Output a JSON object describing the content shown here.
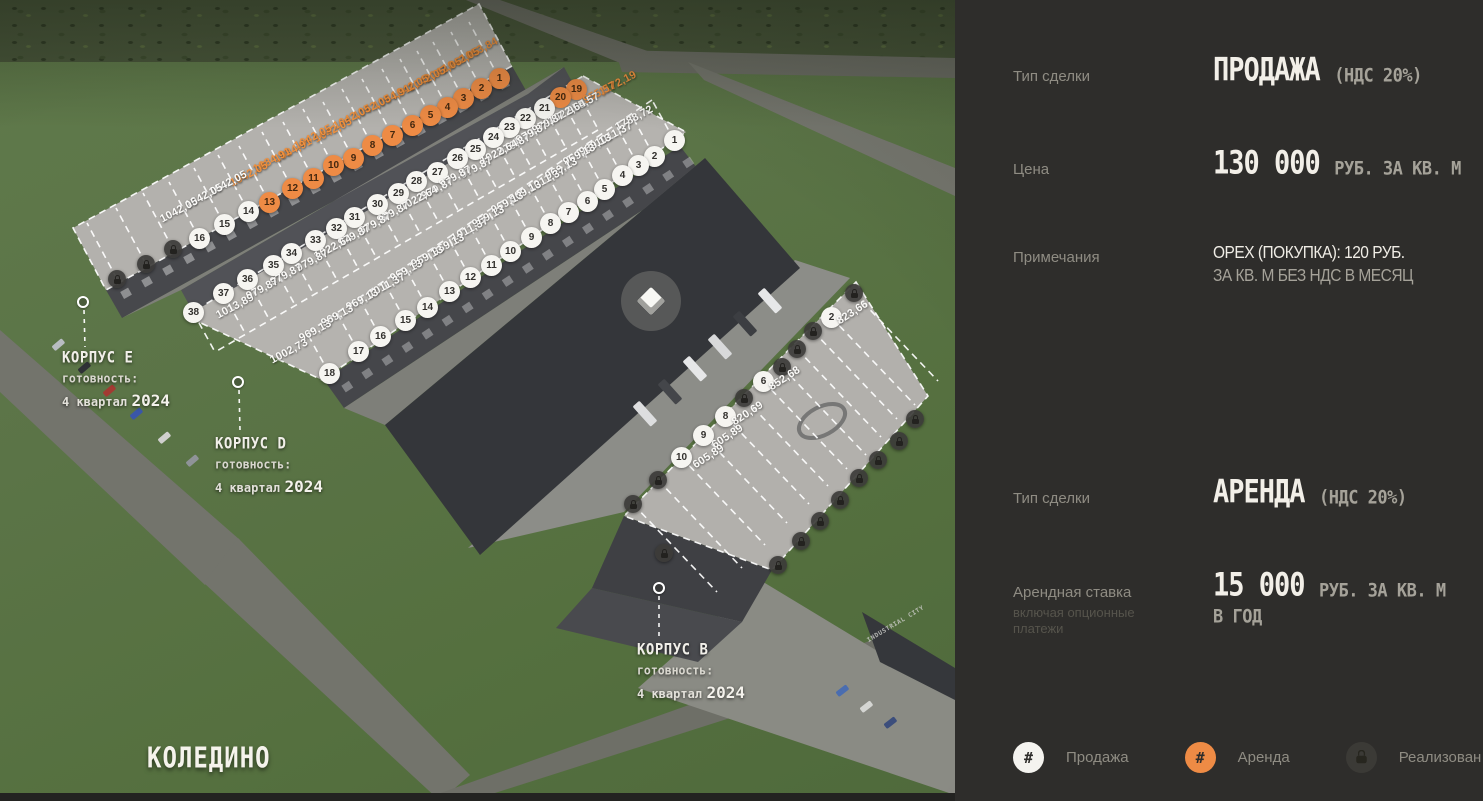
{
  "project": {
    "title": "КОЛЕДИНО"
  },
  "sidebar": {
    "sale": {
      "type_label": "Тип сделки",
      "type_value": "ПРОДАЖА",
      "vat": "(НДС 20%)",
      "price_label": "Цена",
      "price_value": "130 000",
      "price_unit": "РУБ. ЗА КВ. М",
      "notes_label": "Примечания",
      "note_line1": "OPEX (ПОКУПКА): 120 РУБ.",
      "note_line2": "ЗА КВ. М БЕЗ НДС В МЕСЯЦ"
    },
    "rent": {
      "type_label": "Тип сделки",
      "type_value": "АРЕНДА",
      "vat": "(НДС 20%)",
      "rate_label": "Арендная ставка",
      "rate_sublabel1": "включая опционные",
      "rate_sublabel2": "платежи",
      "rate_value": "15 000",
      "rate_unit": "РУБ. ЗА КВ. М",
      "rate_unit2": "В ГОД"
    },
    "legend": [
      {
        "type": "sale",
        "icon": "#",
        "label": "Продажа"
      },
      {
        "type": "rent",
        "icon": "#",
        "label": "Аренда"
      },
      {
        "type": "sold",
        "icon": "lock",
        "label": "Реализован"
      }
    ]
  },
  "map": {
    "sign": "INDUSTRIAL CITY",
    "colors": {
      "accent_orange": "#ee8b45",
      "sale_white": "#f6f5f1",
      "sold_gray": "#3c3b38"
    },
    "buildings": [
      {
        "id": "E",
        "name": "КОРПУС E",
        "ready_label": "готовность:",
        "ready_quarter": "4 квартал",
        "ready_year": "2024",
        "label_x": 62,
        "label_y": 350,
        "dot_x": 83,
        "dot_y": 302,
        "rows": [
          {
            "geom": "E",
            "units": [
              {
                "num": "1",
                "status": "rent",
                "area": "1053,84",
                "x": 499,
                "y": 78,
                "lx": 461,
                "ly": 60
              },
              {
                "num": "2",
                "status": "rent",
                "area": "1042,05",
                "x": 481,
                "y": 88,
                "lx": 443,
                "ly": 70
              },
              {
                "num": "3",
                "status": "rent",
                "area": "1042,05",
                "x": 463,
                "y": 98,
                "lx": 425,
                "ly": 80
              },
              {
                "num": "4",
                "status": "rent",
                "area": "1042,05",
                "x": 447,
                "y": 107,
                "lx": 409,
                "ly": 89
              },
              {
                "num": "5",
                "status": "rent",
                "area": "1042,05",
                "x": 430,
                "y": 115,
                "lx": 392,
                "ly": 97
              },
              {
                "num": "6",
                "status": "rent",
                "area": "1084,91",
                "x": 412,
                "y": 125,
                "lx": 374,
                "ly": 107
              },
              {
                "num": "7",
                "status": "rent",
                "area": "1042,05",
                "x": 392,
                "y": 135,
                "lx": 354,
                "ly": 117
              },
              {
                "num": "8",
                "status": "rent",
                "area": "1042,05",
                "x": 372,
                "y": 145,
                "lx": 334,
                "ly": 127
              },
              {
                "num": "9",
                "status": "rent",
                "area": "1042,05",
                "x": 353,
                "y": 158,
                "lx": 315,
                "ly": 140
              },
              {
                "num": "10",
                "status": "rent",
                "area": "1042,05",
                "x": 333,
                "y": 165,
                "lx": 295,
                "ly": 147
              },
              {
                "num": "11",
                "status": "rent",
                "area": "1084,91",
                "x": 313,
                "y": 178,
                "lx": 275,
                "ly": 160
              },
              {
                "num": "12",
                "status": "rent",
                "area": "1084,91",
                "x": 292,
                "y": 188,
                "lx": 254,
                "ly": 170
              },
              {
                "num": "13",
                "status": "rent",
                "area": "1042,05",
                "x": 269,
                "y": 202,
                "lx": 231,
                "ly": 184
              },
              {
                "num": "14",
                "status": "sale",
                "area": "1042,05",
                "x": 248,
                "y": 211,
                "lx": 210,
                "ly": 193
              },
              {
                "num": "15",
                "status": "sale",
                "area": "1042,05",
                "x": 224,
                "y": 224,
                "lx": 186,
                "ly": 206
              },
              {
                "num": "16",
                "status": "sale",
                "area": "1042,05",
                "x": 199,
                "y": 238,
                "lx": 161,
                "ly": 220
              },
              {
                "status": "sold",
                "x": 173,
                "y": 249
              },
              {
                "status": "sold",
                "x": 146,
                "y": 264
              },
              {
                "status": "sold",
                "x": 117,
                "y": 279
              }
            ]
          }
        ]
      },
      {
        "id": "D",
        "name": "КОРПУС D",
        "ready_label": "готовность:",
        "ready_quarter": "4 квартал",
        "ready_year": "2024",
        "label_x": 215,
        "label_y": 436,
        "dot_x": 238,
        "dot_y": 382,
        "rows": [
          {
            "geom": "DL",
            "units": [
              {
                "num": "19",
                "status": "rent",
                "area": "1172,19",
                "x": 576,
                "y": 89,
                "lx": 600,
                "ly": 93
              },
              {
                "num": "20",
                "status": "rent",
                "area": "955,57",
                "x": 560,
                "y": 97,
                "lx": 584,
                "ly": 101
              },
              {
                "num": "21",
                "status": "sale",
                "area": "955,57",
                "x": 544,
                "y": 108,
                "lx": 568,
                "ly": 112
              },
              {
                "num": "22",
                "status": "sale",
                "area": "1022,64",
                "x": 525,
                "y": 118,
                "lx": 549,
                "ly": 122
              },
              {
                "num": "23",
                "status": "sale",
                "area": "979,87",
                "x": 509,
                "y": 127,
                "lx": 533,
                "ly": 131
              },
              {
                "num": "24",
                "status": "sale",
                "area": "979,87",
                "x": 493,
                "y": 137,
                "lx": 517,
                "ly": 141
              },
              {
                "num": "25",
                "status": "sale",
                "area": "979,87",
                "x": 475,
                "y": 149,
                "lx": 499,
                "ly": 153
              },
              {
                "num": "26",
                "status": "sale",
                "area": "1022,64",
                "x": 457,
                "y": 158,
                "lx": 481,
                "ly": 162
              },
              {
                "num": "27",
                "status": "sale",
                "area": "979,87",
                "x": 437,
                "y": 172,
                "lx": 461,
                "ly": 176
              },
              {
                "num": "28",
                "status": "sale",
                "area": "979,87",
                "x": 416,
                "y": 181,
                "lx": 440,
                "ly": 185
              },
              {
                "num": "29",
                "status": "sale",
                "area": "979,87",
                "x": 398,
                "y": 193,
                "lx": 422,
                "ly": 197
              },
              {
                "num": "30",
                "status": "sale",
                "area": "1022,64",
                "x": 377,
                "y": 204,
                "lx": 401,
                "ly": 208
              },
              {
                "num": "31",
                "status": "sale",
                "area": "979,87",
                "x": 354,
                "y": 217,
                "lx": 378,
                "ly": 221
              },
              {
                "num": "32",
                "status": "sale",
                "area": "979,87",
                "x": 336,
                "y": 228,
                "lx": 360,
                "ly": 232
              },
              {
                "num": "33",
                "status": "sale",
                "area": "979,87",
                "x": 315,
                "y": 240,
                "lx": 339,
                "ly": 244
              },
              {
                "num": "34",
                "status": "sale",
                "area": "1022,64",
                "x": 291,
                "y": 253,
                "lx": 315,
                "ly": 257
              },
              {
                "num": "35",
                "status": "sale",
                "area": "979,87",
                "x": 273,
                "y": 265,
                "lx": 297,
                "ly": 269
              },
              {
                "num": "36",
                "status": "sale",
                "area": "979,87",
                "x": 247,
                "y": 279,
                "lx": 271,
                "ly": 283
              },
              {
                "num": "37",
                "status": "sale",
                "area": "979,87",
                "x": 223,
                "y": 293,
                "lx": 247,
                "ly": 297
              },
              {
                "num": "38",
                "status": "sale",
                "area": "1013,89",
                "x": 193,
                "y": 312,
                "lx": 217,
                "ly": 316
              }
            ]
          },
          {
            "geom": "DR",
            "units": [
              {
                "num": "1",
                "status": "sale",
                "area": "1788,72",
                "x": 674,
                "y": 140,
                "lx": 616,
                "ly": 128
              },
              {
                "num": "2",
                "status": "sale",
                "area": "1011,37",
                "x": 654,
                "y": 156,
                "lx": 596,
                "ly": 144
              },
              {
                "num": "3",
                "status": "sale",
                "area": "969,13",
                "x": 638,
                "y": 165,
                "lx": 580,
                "ly": 153
              },
              {
                "num": "4",
                "status": "sale",
                "area": "969,13",
                "x": 622,
                "y": 175,
                "lx": 564,
                "ly": 163
              },
              {
                "num": "5",
                "status": "sale",
                "area": "969,13",
                "x": 604,
                "y": 189,
                "lx": 546,
                "ly": 177
              },
              {
                "num": "6",
                "status": "sale",
                "area": "1011,37",
                "x": 587,
                "y": 201,
                "lx": 529,
                "ly": 189
              },
              {
                "num": "7",
                "status": "sale",
                "area": "969,13",
                "x": 568,
                "y": 212,
                "lx": 510,
                "ly": 200
              },
              {
                "num": "8",
                "status": "sale",
                "area": "969,13",
                "x": 550,
                "y": 223,
                "lx": 492,
                "ly": 211
              },
              {
                "num": "9",
                "status": "sale",
                "area": "969,13",
                "x": 531,
                "y": 237,
                "lx": 473,
                "ly": 225
              },
              {
                "num": "10",
                "status": "sale",
                "area": "1011,37",
                "x": 510,
                "y": 251,
                "lx": 452,
                "ly": 239
              },
              {
                "num": "11",
                "status": "sale",
                "area": "969,13",
                "x": 491,
                "y": 265,
                "lx": 433,
                "ly": 253
              },
              {
                "num": "12",
                "status": "sale",
                "area": "969,13",
                "x": 470,
                "y": 277,
                "lx": 412,
                "ly": 265
              },
              {
                "num": "13",
                "status": "sale",
                "area": "969,13",
                "x": 449,
                "y": 291,
                "lx": 391,
                "ly": 279
              },
              {
                "num": "14",
                "status": "sale",
                "area": "1011,37",
                "x": 427,
                "y": 307,
                "lx": 369,
                "ly": 295
              },
              {
                "num": "15",
                "status": "sale",
                "area": "969,13",
                "x": 405,
                "y": 320,
                "lx": 347,
                "ly": 308
              },
              {
                "num": "16",
                "status": "sale",
                "area": "969,13",
                "x": 380,
                "y": 336,
                "lx": 322,
                "ly": 324
              },
              {
                "num": "17",
                "status": "sale",
                "area": "969,13",
                "x": 358,
                "y": 351,
                "lx": 300,
                "ly": 339
              },
              {
                "num": "18",
                "status": "sale",
                "area": "1002,73",
                "x": 329,
                "y": 373,
                "lx": 271,
                "ly": 361
              }
            ]
          }
        ]
      },
      {
        "id": "B",
        "name": "КОРПУС B",
        "ready_label": "готовность:",
        "ready_quarter": "4 квартал",
        "ready_year": "2024",
        "label_x": 637,
        "label_y": 642,
        "dot_x": 659,
        "dot_y": 588,
        "rows": [
          {
            "geom": "BL",
            "units": [
              {
                "status": "sold",
                "x": 854,
                "y": 293
              },
              {
                "num": "2",
                "status": "sale",
                "area": "823,66",
                "x": 831,
                "y": 317,
                "lx": 838,
                "ly": 322
              },
              {
                "status": "sold",
                "x": 813,
                "y": 331
              },
              {
                "status": "sold",
                "x": 797,
                "y": 349
              },
              {
                "status": "sold",
                "x": 782,
                "y": 367
              },
              {
                "num": "6",
                "status": "sale",
                "area": "852,68",
                "x": 763,
                "y": 381,
                "lx": 770,
                "ly": 388
              },
              {
                "status": "sold",
                "x": 744,
                "y": 398
              },
              {
                "num": "8",
                "status": "sale",
                "area": "820,69",
                "x": 725,
                "y": 416,
                "lx": 733,
                "ly": 423
              },
              {
                "num": "9",
                "status": "sale",
                "area": "605,89",
                "x": 703,
                "y": 435,
                "lx": 713,
                "ly": 446
              },
              {
                "num": "10",
                "status": "sale",
                "area": "605,89",
                "x": 681,
                "y": 457,
                "lx": 694,
                "ly": 466
              },
              {
                "status": "sold",
                "x": 658,
                "y": 480
              },
              {
                "status": "sold",
                "x": 633,
                "y": 504
              }
            ]
          },
          {
            "geom": "BR",
            "units": [
              {
                "status": "sold",
                "x": 915,
                "y": 419
              },
              {
                "status": "sold",
                "x": 899,
                "y": 441
              },
              {
                "status": "sold",
                "x": 878,
                "y": 460
              },
              {
                "status": "sold",
                "x": 859,
                "y": 478
              },
              {
                "status": "sold",
                "x": 840,
                "y": 500
              },
              {
                "status": "sold",
                "x": 820,
                "y": 521
              },
              {
                "status": "sold",
                "x": 801,
                "y": 541
              },
              {
                "status": "sold",
                "x": 778,
                "y": 565
              },
              {
                "status": "sold",
                "x": 664,
                "y": 553
              }
            ]
          }
        ]
      }
    ]
  }
}
